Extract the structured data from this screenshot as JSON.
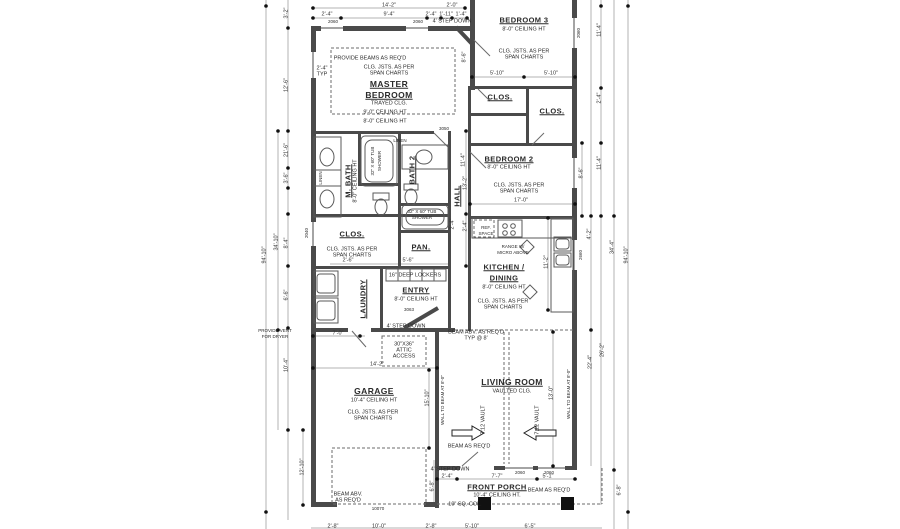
{
  "rooms": {
    "master1": "MASTER",
    "master2": "BEDROOM",
    "trayed": "TRAYED CLG.",
    "ht9": "9'-0\" CEILING HT",
    "ht8": "8'-0\" CEILING HT",
    "bedroom3": "BEDROOM 3",
    "bedroom2": "BEDROOM 2",
    "clos": "CLOS.",
    "mbath": "M. BATH",
    "bath2": "BATH 2",
    "hall": "HALL",
    "pan": "PAN.",
    "kitchen1": "KITCHEN /",
    "kitchen2": "DINING",
    "laundry": "LAUNDRY",
    "entry": "ENTRY",
    "garage": "GARAGE",
    "ht10": "10'-4\" CEILING HT",
    "living": "LIVING ROOM",
    "vaulted": "VAULTED CLG.",
    "porch": "FRONT PORCH",
    "ht10p": "10'-4\" CEILING HT."
  },
  "notes": {
    "beams": "PROVIDE BEAMS AS REQ'D",
    "joists1": "CLG. JSTS. AS PER",
    "joists2": "SPAN CHARTS",
    "typ1": "2'-4\"",
    "typ2": "TYP",
    "step": "4' STEP DOWN",
    "linen": "LINEN",
    "tub1": "32\" X 60\" TUB",
    "tub2": "SHOWER",
    "ref1": "REF.",
    "ref2": "SPACE",
    "range1": "RANGE W/",
    "range2": "MICRO ABOVE",
    "lockers": "16\" DEEP LOCKERS",
    "attic1": "30\"X36\"",
    "attic2": "ATTIC",
    "attic3": "ACCESS",
    "beamabv1": "BEAM ABV. AS REQ'D",
    "beamabv2": "TYP @ 8'",
    "beamreq": "BEAM AS REQ'D",
    "vault": "7:12 VAULT",
    "wallbeam": "WALL TO BEAM AT 8'-0\"",
    "sqcol": "10\" SQ. COL.",
    "beamg1": "BEAM ABV.",
    "beamg2": "AS REQ'D",
    "vent1": "PROVIDE VENT",
    "vent2": "FOR DRYER"
  },
  "openings": {
    "w2060": "2060",
    "w2040": "2040",
    "w2660": "2660",
    "w3050": "3050",
    "d3063": "3063",
    "d10070": "10070"
  },
  "dims": {
    "t14_2": "14'-2\"",
    "t2_0": "2'-0\"",
    "t2_4a": "2'-4\"",
    "t9_4": "9'-4\"",
    "t2_4b": "2'-4\"",
    "t1_11": "1'-11\"",
    "t1_4": "1'-4\"",
    "l94_10": "94'-10\"",
    "l34_10": "34'-10\"",
    "l3_2": "3'-2\"",
    "l12_6": "12'-6\"",
    "l21_6": "21'-6\"",
    "l3_6": "3'-6\"",
    "l8_4": "8'-4\"",
    "l6_6": "6'-6\"",
    "l10_4": "10'-4\"",
    "l12_10": "12'-10\"",
    "r11_4": "11'-4\"",
    "r2_4": "2'-4\"",
    "r8_6": "8'-6\"",
    "r4_2": "4'-2\"",
    "r34_4": "34'-4\"",
    "r94_10": "94'-10\"",
    "r22_4": "22'-4\"",
    "r26_2": "26'-2\"",
    "r6_8": "6'-8\"",
    "b5_10": "5'-10\"",
    "b8_6": "8'-6\"",
    "b17_0": "17'-0\"",
    "b11_4": "11'-4\"",
    "h13_2": "13'-2\"",
    "h2_4": "2'-4\"",
    "k11_2": "11'-2\"",
    "k2_4": "2'-4\"",
    "c2_6": "2'-6\"",
    "c5_6": "5'-6\"",
    "e7_0": "7'-0\"",
    "g14_2": "14'-2\"",
    "g15_10": "15'-10\"",
    "g12_10": "12'-10\"",
    "g6_8": "6'-8\"",
    "v13_0": "13'-0\"",
    "p2_4": "2'-4\"",
    "p7_7": "7'-7\"",
    "p5_1": "5'-1\"",
    "bb2_8": "2'-8\"",
    "bb10_0": "10'-0\"",
    "bb5_10": "5'-10\"",
    "bb6_5": "6'-5\""
  }
}
